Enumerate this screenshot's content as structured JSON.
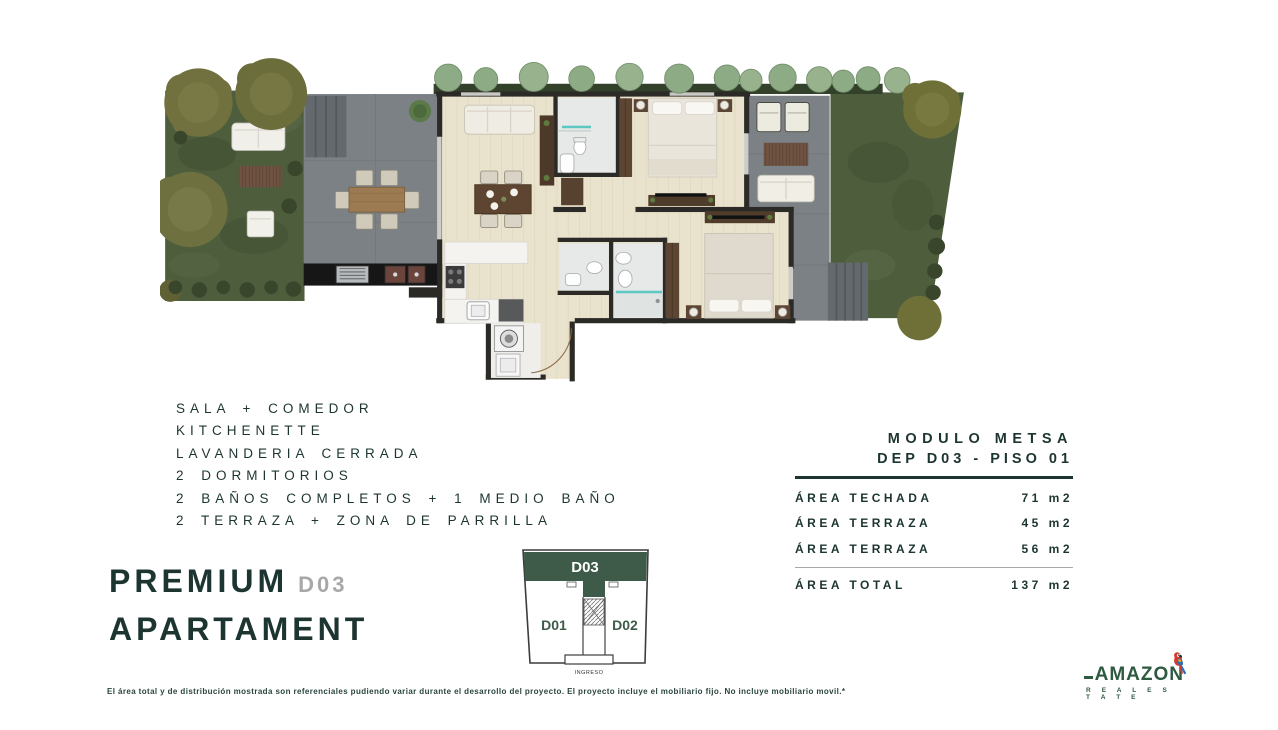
{
  "features": {
    "items": [
      "SALA + COMEDOR",
      "KITCHENETTE",
      "LAVANDERIA CERRADA",
      "2 DORMITORIOS",
      "2 BAÑOS COMPLETOS + 1 MEDIO BAÑO",
      "2 TERRAZA + ZONA DE PARRILLA"
    ]
  },
  "title": {
    "line1": "PREMIUM",
    "unit": "D03",
    "line2": "APARTAMENT"
  },
  "keyplan": {
    "top_unit": "D03",
    "left_unit": "D01",
    "right_unit": "D02",
    "entrance_label": "INGRESO"
  },
  "specs": {
    "module": "MODULO METSA",
    "unit_floor": "DEP D03 - PISO 01",
    "rows": [
      {
        "label": "ÁREA TECHADA",
        "value": "71 m2"
      },
      {
        "label": "ÁREA TERRAZA",
        "value": "45 m2"
      },
      {
        "label": "ÁREA TERRAZA",
        "value": "56 m2"
      }
    ],
    "total": {
      "label": "ÁREA TOTAL",
      "value": "137 m2"
    }
  },
  "disclaimer": "El área total y de distribución mostrada son referenciales pudiendo variar durante el desarrollo del proyecto. El proyecto incluye el mobiliario fijo. No incluye mobiliario movil.*",
  "logo": {
    "brand": "AMAZON",
    "tagline": "R E A L   E S T A T E"
  },
  "colors": {
    "text_dark": "#1d3531",
    "accent_green": "#40604c",
    "muted": "#a8a8a8",
    "logo_green": "#2e5a40",
    "grass": "#4e5e3d",
    "terrace": "#7b8185",
    "wood": "#e9e2cc"
  }
}
